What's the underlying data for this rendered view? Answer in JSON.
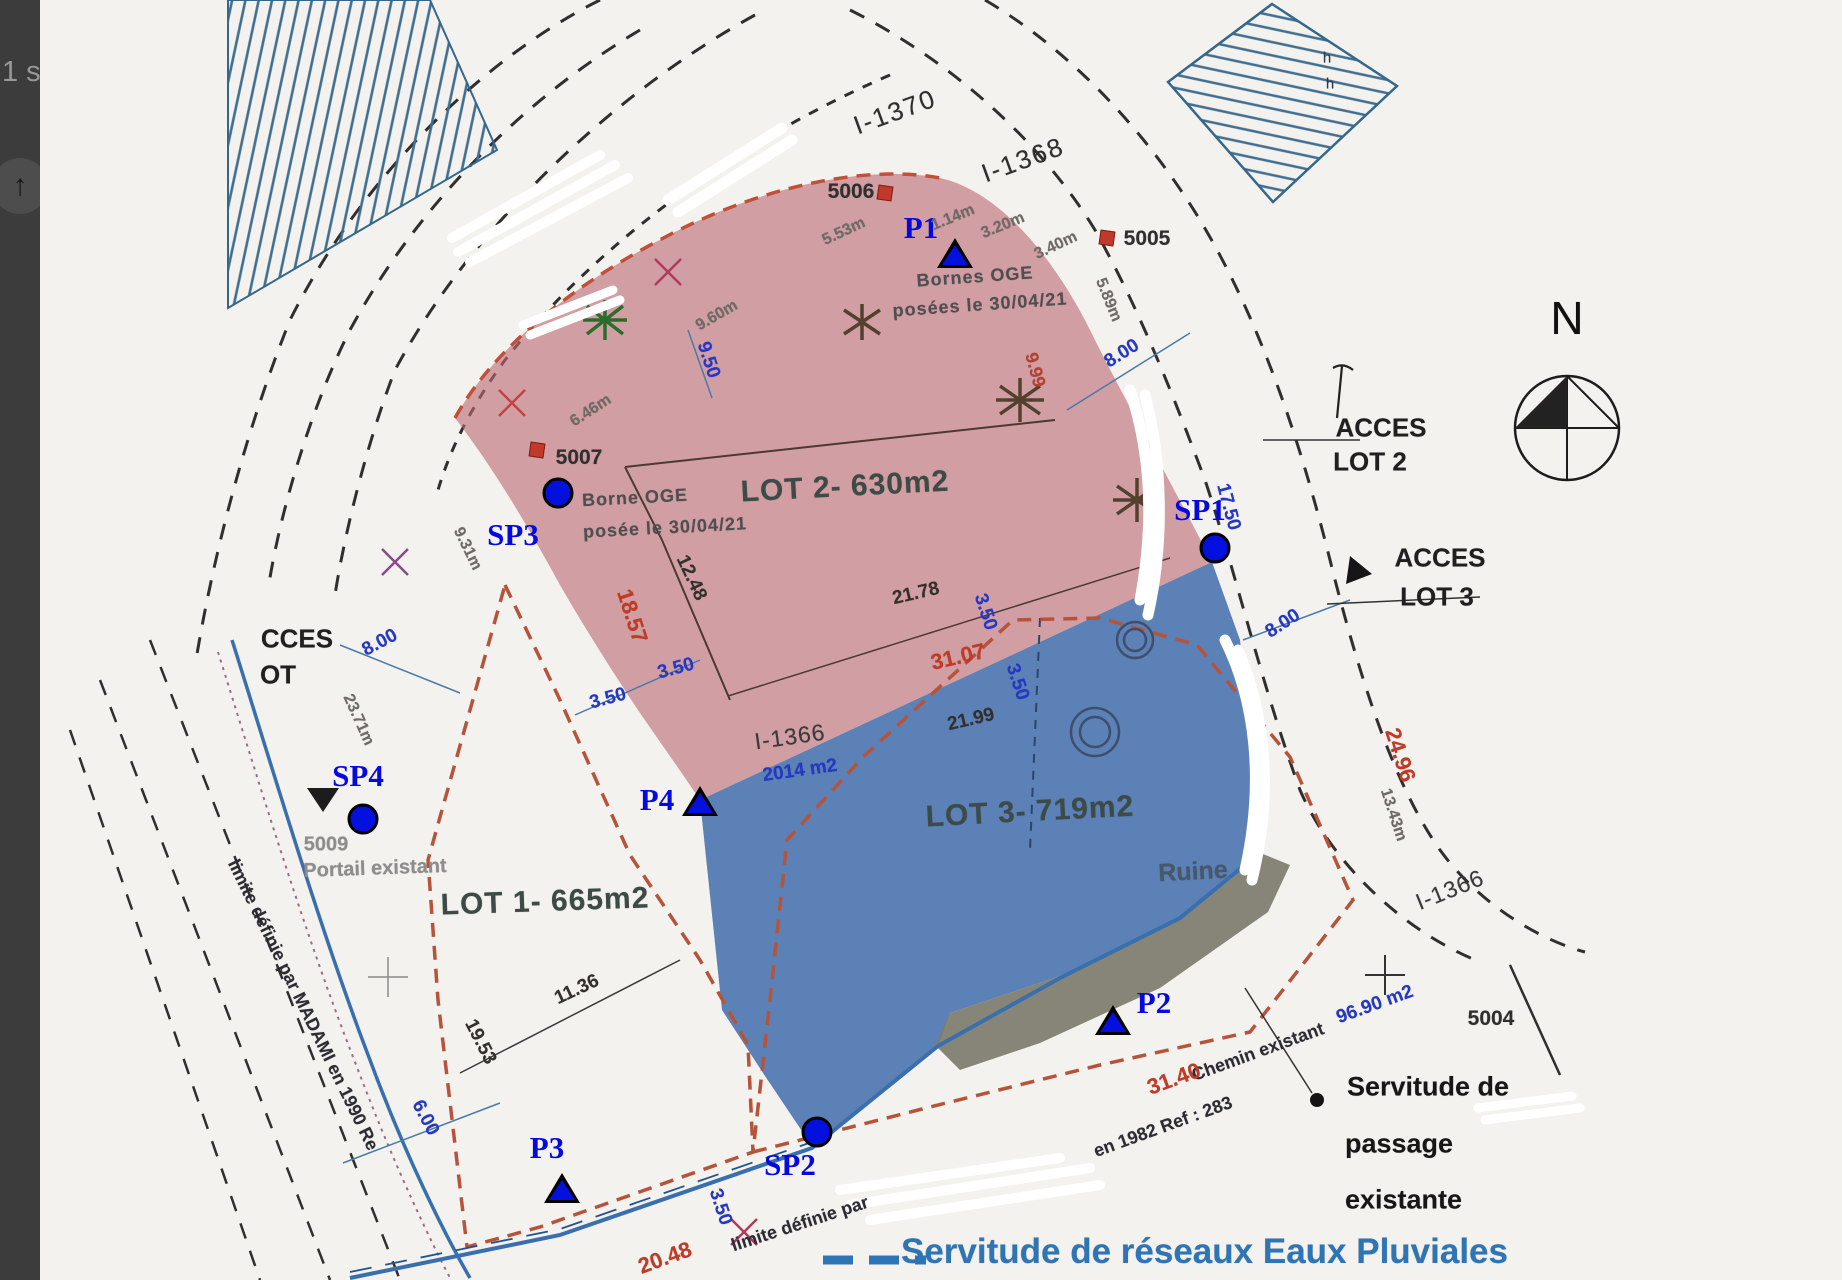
{
  "sidebar": {
    "partial_text": "1 s",
    "scroll_icon": "↑"
  },
  "plan": {
    "lots": [
      {
        "name": "LOT 1",
        "area": "665m2"
      },
      {
        "name": "LOT 2",
        "area": "630m2"
      },
      {
        "name": "LOT 3",
        "area": "719m2"
      }
    ],
    "colors": {
      "lot2_fill": "#bb6b74",
      "lot3_fill": "#3464a8",
      "servitude_strip": "#7d7c6e",
      "marker_blue": "#0410dd",
      "dashed_boundary": "#b5543a",
      "water_line": "#3a6fae",
      "legend_text_blue": "#2e75b6"
    },
    "labels": [
      {
        "t": "I-1370",
        "x": 855,
        "y": 112,
        "r": -20,
        "cls": "road"
      },
      {
        "t": "I-1368",
        "x": 983,
        "y": 160,
        "r": -20,
        "cls": "road"
      },
      {
        "t": "I-1366",
        "x": 750,
        "y": 737,
        "r": -8,
        "cls": "road2"
      },
      {
        "t": "I-1366",
        "x": 1410,
        "y": 890,
        "r": -22,
        "cls": "road2"
      },
      {
        "t": "5006",
        "x": 811,
        "y": 192,
        "r": 0,
        "cls": "num"
      },
      {
        "t": "5005",
        "x": 1107,
        "y": 239,
        "r": 0,
        "cls": "num"
      },
      {
        "t": "5007",
        "x": 539,
        "y": 458,
        "r": 0,
        "cls": "num"
      },
      {
        "t": "5009",
        "x": 286,
        "y": 845,
        "r": 0,
        "cls": "numg"
      },
      {
        "t": "5004",
        "x": 1451,
        "y": 1019,
        "r": 0,
        "cls": "num"
      },
      {
        "t": "P1",
        "x": 881,
        "y": 228,
        "r": 0,
        "cls": "ml"
      },
      {
        "t": "P2",
        "x": 1114,
        "y": 1003,
        "r": 0,
        "cls": "ml"
      },
      {
        "t": "P3",
        "x": 507,
        "y": 1148,
        "r": 0,
        "cls": "ml"
      },
      {
        "t": "P4",
        "x": 617,
        "y": 800,
        "r": 0,
        "cls": "ml"
      },
      {
        "t": "SP1",
        "x": 1160,
        "y": 510,
        "r": 0,
        "cls": "ml"
      },
      {
        "t": "SP2",
        "x": 750,
        "y": 1165,
        "r": 0,
        "cls": "ml"
      },
      {
        "t": "SP3",
        "x": 473,
        "y": 535,
        "r": 0,
        "cls": "ml"
      },
      {
        "t": "SP4",
        "x": 318,
        "y": 776,
        "r": 0,
        "cls": "ml"
      },
      {
        "t": "LOT 2- 630m2",
        "x": 805,
        "y": 487,
        "r": -3,
        "cls": "lot"
      },
      {
        "t": "LOT 3- 719m2",
        "x": 990,
        "y": 812,
        "r": -3,
        "cls": "lot"
      },
      {
        "t": "LOT 1- 665m2",
        "x": 505,
        "y": 902,
        "r": -2,
        "cls": "lot"
      },
      {
        "t": "Ruine",
        "x": 1153,
        "y": 872,
        "r": -3,
        "cls": "ruine"
      },
      {
        "t": "ACCES",
        "x": 1341,
        "y": 428,
        "r": 0,
        "cls": "acc"
      },
      {
        "t": "LOT 2",
        "x": 1330,
        "y": 462,
        "r": 0,
        "cls": "acc"
      },
      {
        "t": "ACCES",
        "x": 1400,
        "y": 558,
        "r": 0,
        "cls": "acc"
      },
      {
        "t": "LOT 3",
        "x": 1397,
        "y": 597,
        "r": 0,
        "cls": "acc"
      },
      {
        "t": "CCES",
        "x": 257,
        "y": 639,
        "r": 0,
        "cls": "acc"
      },
      {
        "t": "OT",
        "x": 238,
        "y": 675,
        "r": 0,
        "cls": "acc"
      },
      {
        "t": "N",
        "x": 1527,
        "y": 318,
        "r": 0,
        "cls": "nl"
      },
      {
        "t": "Servitude de",
        "x": 1307,
        "y": 1087,
        "r": 0,
        "cls": "serv",
        "a": "l"
      },
      {
        "t": "passage",
        "x": 1305,
        "y": 1144,
        "r": 0,
        "cls": "serv",
        "a": "l"
      },
      {
        "t": "existante",
        "x": 1305,
        "y": 1200,
        "r": 0,
        "cls": "serv",
        "a": "l"
      },
      {
        "t": "Servitude de réseaux Eaux Pluviales",
        "x": 861,
        "y": 1252,
        "r": 0,
        "cls": "bluebig",
        "a": "l"
      },
      {
        "t": "Bornes OGE",
        "x": 935,
        "y": 277,
        "r": -4,
        "cls": "scan"
      },
      {
        "t": "posées le 30/04/21",
        "x": 940,
        "y": 305,
        "r": -4,
        "cls": "scan"
      },
      {
        "t": "Borne OGE",
        "x": 595,
        "y": 498,
        "r": -3,
        "cls": "scan"
      },
      {
        "t": "posée le 30/04/21",
        "x": 625,
        "y": 528,
        "r": -3,
        "cls": "scan"
      },
      {
        "t": "Portail existant",
        "x": 335,
        "y": 869,
        "r": -2,
        "cls": "numg"
      },
      {
        "t": "Chemin existant",
        "x": 1218,
        "y": 1052,
        "r": -20,
        "cls": "scand"
      },
      {
        "t": "limite définie par MADAMI en 1990 Re",
        "x": 263,
        "y": 1005,
        "r": 64,
        "cls": "scand"
      },
      {
        "t": "limite définie par",
        "x": 760,
        "y": 1224,
        "r": -18,
        "cls": "scand"
      },
      {
        "t": "en 1982 Ref : 283",
        "x": 1123,
        "y": 1127,
        "r": -20,
        "cls": "scand"
      },
      {
        "t": "21.78",
        "x": 876,
        "y": 594,
        "r": -13,
        "cls": "dim"
      },
      {
        "t": "21.99",
        "x": 931,
        "y": 720,
        "r": -13,
        "cls": "dim"
      },
      {
        "t": "11.36",
        "x": 537,
        "y": 990,
        "r": -25,
        "cls": "dim"
      },
      {
        "t": "19.53",
        "x": 440,
        "y": 1042,
        "r": 63,
        "cls": "dim"
      },
      {
        "t": "12.48",
        "x": 651,
        "y": 578,
        "r": 65,
        "cls": "dim"
      },
      {
        "t": "5.53m",
        "x": 804,
        "y": 232,
        "r": -25,
        "cls": "dims"
      },
      {
        "t": "1.14m",
        "x": 913,
        "y": 218,
        "r": -22,
        "cls": "dims"
      },
      {
        "t": "3.20m",
        "x": 963,
        "y": 226,
        "r": -22,
        "cls": "dims"
      },
      {
        "t": "3.40m",
        "x": 1016,
        "y": 246,
        "r": -25,
        "cls": "dims"
      },
      {
        "t": "5.89m",
        "x": 1068,
        "y": 300,
        "r": 68,
        "cls": "dims"
      },
      {
        "t": "9.60m",
        "x": 677,
        "y": 316,
        "r": -30,
        "cls": "dims"
      },
      {
        "t": "6.46m",
        "x": 551,
        "y": 411,
        "r": -33,
        "cls": "dims"
      },
      {
        "t": "23.71m",
        "x": 318,
        "y": 720,
        "r": 66,
        "cls": "dims"
      },
      {
        "t": "9.31m",
        "x": 427,
        "y": 549,
        "r": 64,
        "cls": "dims"
      },
      {
        "t": "13.43m",
        "x": 1353,
        "y": 815,
        "r": 72,
        "cls": "dims"
      },
      {
        "t": "9.50",
        "x": 668,
        "y": 360,
        "r": 72,
        "cls": "dimb"
      },
      {
        "t": "8.00",
        "x": 1082,
        "y": 354,
        "r": -32,
        "cls": "dimb"
      },
      {
        "t": "8.00",
        "x": 1243,
        "y": 624,
        "r": -33,
        "cls": "dimb"
      },
      {
        "t": "8.00",
        "x": 340,
        "y": 643,
        "r": -28,
        "cls": "dimb"
      },
      {
        "t": "3.50",
        "x": 568,
        "y": 699,
        "r": -15,
        "cls": "dimb"
      },
      {
        "t": "3.50",
        "x": 636,
        "y": 669,
        "r": -15,
        "cls": "dimb"
      },
      {
        "t": "3.50",
        "x": 945,
        "y": 612,
        "r": 72,
        "cls": "dimb"
      },
      {
        "t": "3.50",
        "x": 977,
        "y": 682,
        "r": 72,
        "cls": "dimb"
      },
      {
        "t": "3.50",
        "x": 680,
        "y": 1207,
        "r": 72,
        "cls": "dimb"
      },
      {
        "t": "17.50",
        "x": 1188,
        "y": 507,
        "r": 75,
        "cls": "dimb"
      },
      {
        "t": "2014 m2",
        "x": 760,
        "y": 771,
        "r": -8,
        "cls": "dimb"
      },
      {
        "t": "96.90 m2",
        "x": 1335,
        "y": 1005,
        "r": -20,
        "cls": "dimb"
      },
      {
        "t": "6.00",
        "x": 385,
        "y": 1118,
        "r": 62,
        "cls": "dimb"
      },
      {
        "t": "18.57",
        "x": 592,
        "y": 616,
        "r": 72,
        "cls": "dimr"
      },
      {
        "t": "31.07",
        "x": 918,
        "y": 657,
        "r": -13,
        "cls": "dimr"
      },
      {
        "t": "24.96",
        "x": 1360,
        "y": 755,
        "r": 72,
        "cls": "dimr"
      },
      {
        "t": "20.48",
        "x": 625,
        "y": 1258,
        "r": -20,
        "cls": "dimr"
      },
      {
        "t": "31.40",
        "x": 1134,
        "y": 1079,
        "r": -20,
        "cls": "dimr"
      },
      {
        "t": "9.99",
        "x": 995,
        "y": 370,
        "r": 75,
        "cls": "dimrs"
      },
      {
        "t": "h",
        "x": 1287,
        "y": 58,
        "r": 0,
        "cls": "hh"
      },
      {
        "t": "h",
        "x": 1290,
        "y": 84,
        "r": 0,
        "cls": "hh"
      }
    ],
    "points": [
      {
        "id": "P1",
        "type": "triangle",
        "x": 915,
        "y": 253
      },
      {
        "id": "P2",
        "type": "triangle",
        "x": 1073,
        "y": 1020
      },
      {
        "id": "P3",
        "type": "triangle",
        "x": 522,
        "y": 1188
      },
      {
        "id": "P4",
        "type": "triangle",
        "x": 660,
        "y": 801
      },
      {
        "id": "SP1",
        "type": "circle",
        "x": 1175,
        "y": 548
      },
      {
        "id": "SP2",
        "type": "circle",
        "x": 777,
        "y": 1132
      },
      {
        "id": "SP3",
        "type": "circle",
        "x": 518,
        "y": 493
      },
      {
        "id": "SP4",
        "type": "circle",
        "x": 323,
        "y": 819
      }
    ],
    "bornes": [
      {
        "id": "5006",
        "x": 845,
        "y": 193
      },
      {
        "id": "5005",
        "x": 1067,
        "y": 238
      },
      {
        "id": "5007",
        "x": 497,
        "y": 450
      }
    ]
  }
}
